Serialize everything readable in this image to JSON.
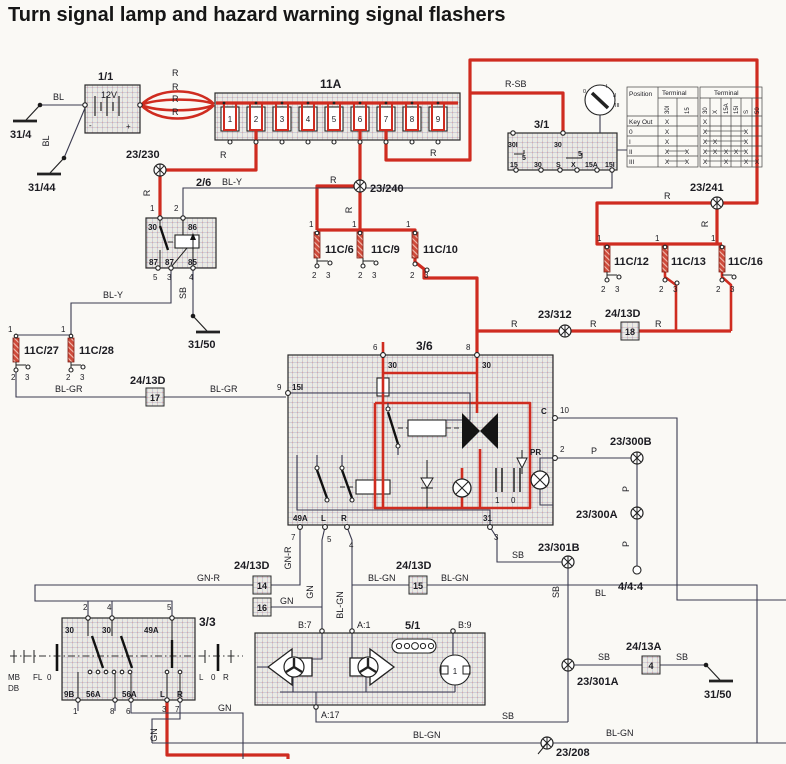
{
  "title": "Turn signal lamp and hazard warning signal flashers",
  "wires": {
    "r": "R",
    "rsb": "R-SB",
    "bl": "BL",
    "bly": "BL-Y",
    "sb": "SB",
    "blgr": "BL-GR",
    "gnr": "GN-R",
    "gn": "GN",
    "blgn": "BL-GN",
    "p": "P"
  },
  "pins": {
    "p1": "1",
    "p2": "2",
    "p3": "3",
    "p4": "4",
    "p5": "5",
    "p6": "6",
    "p7": "7",
    "p8": "8",
    "p9": "9",
    "p10": "10"
  },
  "battery": {
    "id": "1/1",
    "voltage": "12V",
    "plus": "+",
    "minus": "-"
  },
  "grounds": {
    "g31_4": "31/4",
    "g31_44": "31/44",
    "g31_50": "31/50"
  },
  "fusebox": {
    "id": "11A",
    "fuses": [
      "1",
      "2",
      "3",
      "4",
      "5",
      "6",
      "7",
      "8",
      "9"
    ]
  },
  "ignition": {
    "id": "3/1",
    "t30i": "30I",
    "t30": "30",
    "t5": "5",
    "t15": "15",
    "ts": "S",
    "tx": "X",
    "t15a": "15A",
    "t15ii": "15I",
    "key_positions": {
      "k0": "0",
      "k1": "I",
      "k2": "II",
      "k3": "III"
    },
    "table": {
      "position": "Position",
      "terminal": "Terminal",
      "mark": "X",
      "rows": {
        "key_out": "Key Out",
        "r0": "0",
        "r1": "I",
        "r2": "II",
        "r3": "III"
      },
      "cols": {
        "c30i": "30I",
        "c15": "15",
        "c30": "30",
        "cx": "X",
        "c15a": "15A",
        "c15i": "15I",
        "cs": "S",
        "c50": "50"
      }
    }
  },
  "relay26": {
    "id": "2/6",
    "t30": "30",
    "t86": "86",
    "t87": "87",
    "t85": "85"
  },
  "flasher36": {
    "id": "3/6",
    "t30": "30",
    "t15i": "15I",
    "tc": "C",
    "tpr": "PR",
    "t49a": "49A",
    "tl": "L",
    "tr": "R",
    "t31": "31",
    "cap1": "1",
    "cap0": "0"
  },
  "switch33": {
    "id": "3/3",
    "t30": "30",
    "t49a": "49A",
    "t9b": "9B",
    "t56a": "56A",
    "tl": "L",
    "tr": "R",
    "mb": "MB",
    "db": "DB",
    "fl": "FL",
    "zero": "0"
  },
  "cluster51": {
    "id": "5/1",
    "b7": "B:7",
    "a1": "A:1",
    "b9": "B:9",
    "a17": "A:17",
    "one": "1"
  },
  "connectors": {
    "c6": "11C/6",
    "c9": "11C/9",
    "c10": "11C/10",
    "c12": "11C/12",
    "c13": "11C/13",
    "c16": "11C/16",
    "c27": "11C/27",
    "c28": "11C/28"
  },
  "inline": {
    "d": "24/13D",
    "a": "24/13A",
    "n17": "17",
    "n18": "18",
    "n14": "14",
    "n15": "15",
    "n16": "16",
    "n4": "4"
  },
  "nodes": {
    "n230": "23/230",
    "n240": "23/240",
    "n241": "23/241",
    "n312": "23/312",
    "n300b": "23/300B",
    "n300a": "23/300A",
    "n301b": "23/301B",
    "n301a": "23/301A",
    "n208": "23/208",
    "n444": "4/4:4"
  }
}
